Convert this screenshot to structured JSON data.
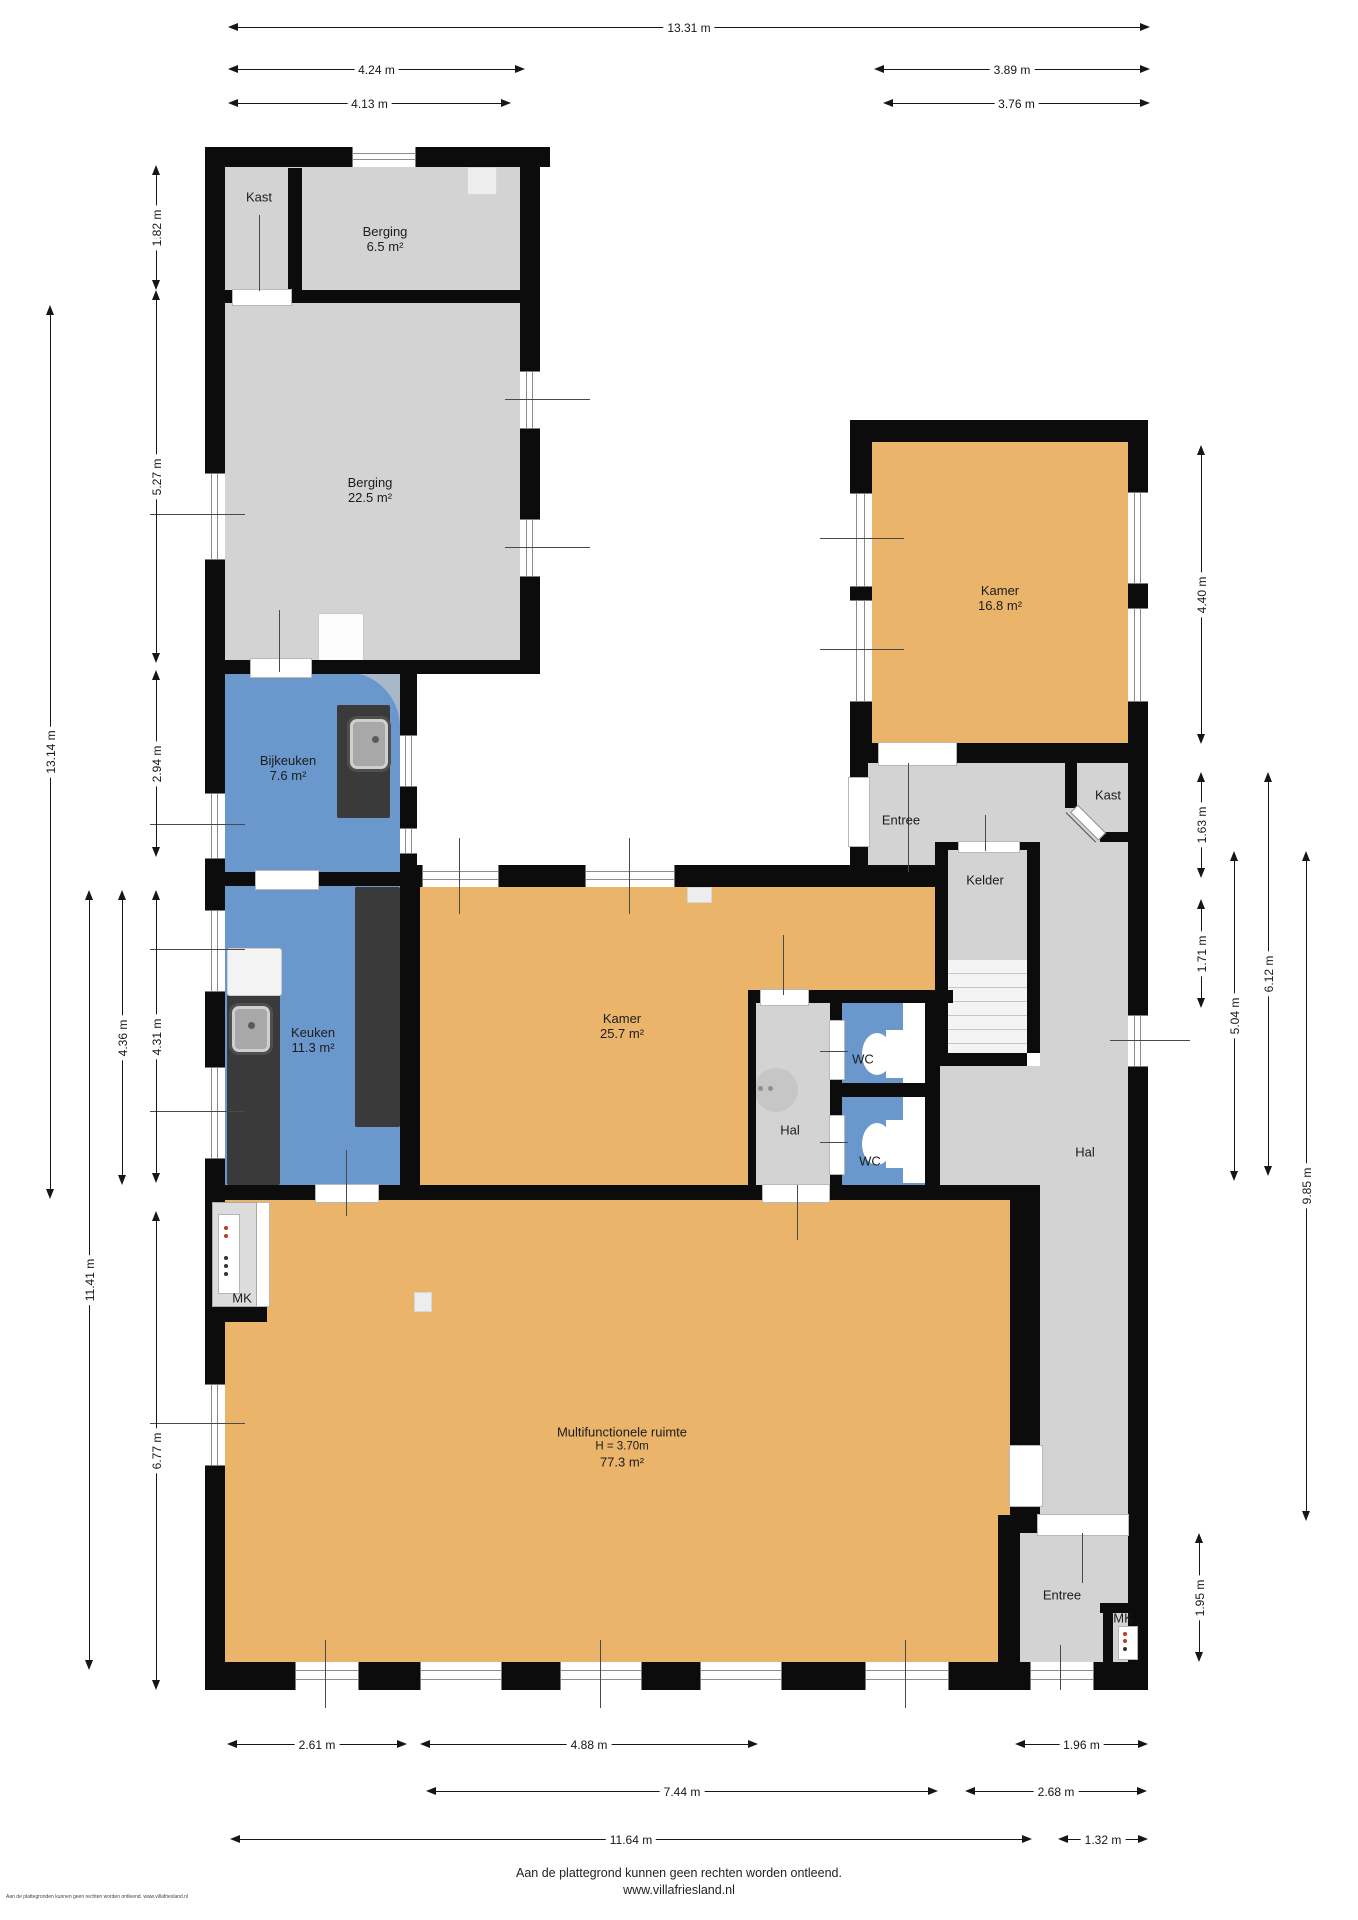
{
  "colors": {
    "wall": "#0c0c0c",
    "floor_grey": "#d2d3d2",
    "floor_orange": "#eab46a",
    "floor_blue": "#6b98cc",
    "counter_dark": "#3a3a3a"
  },
  "rooms": [
    {
      "id": "kast-nw",
      "lines": [
        "Kast"
      ],
      "cx": 259,
      "cy": 197
    },
    {
      "id": "berging-65",
      "lines": [
        "Berging",
        "6.5 m²"
      ],
      "cx": 385,
      "cy": 239
    },
    {
      "id": "berging-225",
      "lines": [
        "Berging",
        "22.5 m²"
      ],
      "cx": 370,
      "cy": 490
    },
    {
      "id": "bijkeuken",
      "lines": [
        "Bijkeuken",
        "7.6 m²"
      ],
      "cx": 288,
      "cy": 768
    },
    {
      "id": "keuken",
      "lines": [
        "Keuken",
        "11.3 m²"
      ],
      "cx": 313,
      "cy": 1040
    },
    {
      "id": "kamer-257",
      "lines": [
        "Kamer",
        "25.7 m²"
      ],
      "cx": 622,
      "cy": 1026
    },
    {
      "id": "kamer-168",
      "lines": [
        "Kamer",
        "16.8 m²"
      ],
      "cx": 1000,
      "cy": 598
    },
    {
      "id": "entree-mid",
      "lines": [
        "Entree"
      ],
      "cx": 901,
      "cy": 820
    },
    {
      "id": "kelder",
      "lines": [
        "Kelder"
      ],
      "cx": 985,
      "cy": 880
    },
    {
      "id": "kast-right",
      "lines": [
        "Kast"
      ],
      "cx": 1108,
      "cy": 795
    },
    {
      "id": "wc-1",
      "lines": [
        "WC"
      ],
      "cx": 863,
      "cy": 1059
    },
    {
      "id": "wc-2",
      "lines": [
        "WC"
      ],
      "cx": 870,
      "cy": 1161
    },
    {
      "id": "hal-center",
      "lines": [
        "Hal"
      ],
      "cx": 790,
      "cy": 1130
    },
    {
      "id": "hal-right",
      "lines": [
        "Hal"
      ],
      "cx": 1085,
      "cy": 1152
    },
    {
      "id": "mk-top",
      "lines": [
        "MK"
      ],
      "cx": 242,
      "cy": 1298
    },
    {
      "id": "mfr",
      "lines": [
        "Multifunctionele ruimte",
        "H = 3.70m",
        "77.3 m²"
      ],
      "cx": 622,
      "cy": 1447,
      "small_lines": [
        1
      ]
    },
    {
      "id": "entree-bottom",
      "lines": [
        "Entree"
      ],
      "cx": 1062,
      "cy": 1595
    },
    {
      "id": "mk-bottom",
      "lines": [
        "MK"
      ],
      "cx": 1123,
      "cy": 1618
    }
  ],
  "dims": {
    "top": [
      {
        "label": "13.31 m",
        "x1": 228,
        "x2": 1150,
        "y": 28
      },
      {
        "label": "4.24 m",
        "x1": 228,
        "x2": 525,
        "y": 70
      },
      {
        "label": "3.89 m",
        "x1": 874,
        "x2": 1150,
        "y": 70
      },
      {
        "label": "4.13 m",
        "x1": 228,
        "x2": 511,
        "y": 104
      },
      {
        "label": "3.76 m",
        "x1": 883,
        "x2": 1150,
        "y": 104
      }
    ],
    "bottom": [
      {
        "label": "2.61 m",
        "x1": 227,
        "x2": 407,
        "y": 1745
      },
      {
        "label": "4.88 m",
        "x1": 420,
        "x2": 758,
        "y": 1745
      },
      {
        "label": "1.96 m",
        "x1": 1015,
        "x2": 1148,
        "y": 1745
      },
      {
        "label": "7.44 m",
        "x1": 426,
        "x2": 938,
        "y": 1792
      },
      {
        "label": "2.68 m",
        "x1": 965,
        "x2": 1147,
        "y": 1792
      },
      {
        "label": "11.64 m",
        "x1": 230,
        "x2": 1032,
        "y": 1840
      },
      {
        "label": "1.32 m",
        "x1": 1058,
        "x2": 1148,
        "y": 1840
      }
    ],
    "left": [
      {
        "label": "13.14 m",
        "x": 51,
        "y1": 305,
        "y2": 1199
      },
      {
        "label": "1.82 m",
        "x": 157,
        "y1": 165,
        "y2": 290
      },
      {
        "label": "5.27 m",
        "x": 157,
        "y1": 290,
        "y2": 663
      },
      {
        "label": "2.94 m",
        "x": 157,
        "y1": 670,
        "y2": 857
      },
      {
        "label": "4.36 m",
        "x": 123,
        "y1": 890,
        "y2": 1185
      },
      {
        "label": "4.31 m",
        "x": 157,
        "y1": 890,
        "y2": 1183
      },
      {
        "label": "11.41 m",
        "x": 90,
        "y1": 890,
        "y2": 1670
      },
      {
        "label": "6.77 m",
        "x": 157,
        "y1": 1211,
        "y2": 1690
      }
    ],
    "right": [
      {
        "label": "4.40 m",
        "x": 1202,
        "y1": 445,
        "y2": 744
      },
      {
        "label": "1.63 m",
        "x": 1202,
        "y1": 772,
        "y2": 878
      },
      {
        "label": "1.71 m",
        "x": 1202,
        "y1": 899,
        "y2": 1008
      },
      {
        "label": "5.04 m",
        "x": 1235,
        "y1": 851,
        "y2": 1181
      },
      {
        "label": "6.12 m",
        "x": 1269,
        "y1": 772,
        "y2": 1176
      },
      {
        "label": "9.85 m",
        "x": 1307,
        "y1": 851,
        "y2": 1521
      },
      {
        "label": "1.95 m",
        "x": 1200,
        "y1": 1533,
        "y2": 1662
      }
    ]
  },
  "footer": {
    "line1": "Aan de plattegrond kunnen geen rechten worden ontleend.",
    "line2": "www.villafriesland.nl",
    "tiny": "Aan de plattegronden kunnen geen rechten worden ontleend. www.villafriesland.nl"
  }
}
